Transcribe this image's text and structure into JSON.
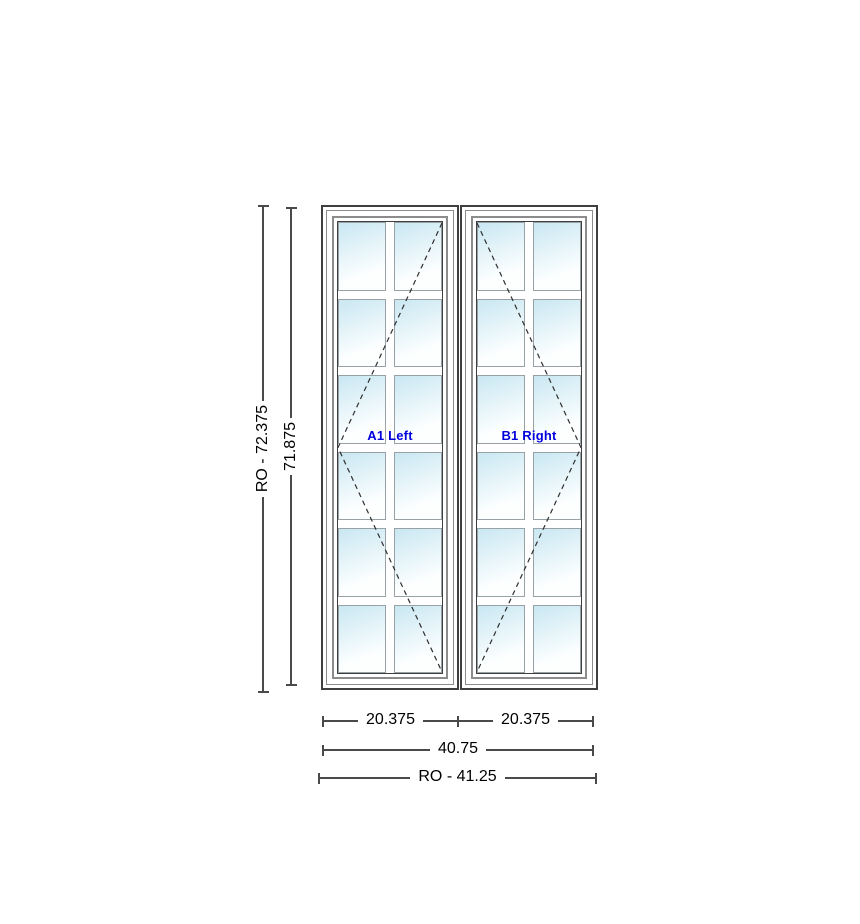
{
  "drawing": {
    "title": "two-panel casement window elevation"
  },
  "windows": [
    {
      "id": "A1",
      "label": "A1 Left",
      "swing": "left",
      "grille_columns": 2,
      "grille_rows": 6,
      "pane_count": 12,
      "width_label": "20.375"
    },
    {
      "id": "B1",
      "label": "B1 Right",
      "swing": "right",
      "grille_columns": 2,
      "grille_rows": 6,
      "pane_count": 12,
      "width_label": "20.375"
    }
  ],
  "dimensions": {
    "rough_opening_height": "RO - 72.375",
    "frame_height": "71.875",
    "sash_widths": [
      "20.375",
      "20.375"
    ],
    "frame_width": "40.75",
    "rough_opening_width": "RO - 41.25"
  },
  "colors": {
    "label_blue": "#0000dd",
    "glass_blue": "#c9e7f2",
    "glass_white": "#fdffff",
    "line_dark": "#3f3f3f",
    "line_mid": "#8c8c8c",
    "muntin_edge": "#98a2a6",
    "dim_line": "#4a4a4a"
  }
}
